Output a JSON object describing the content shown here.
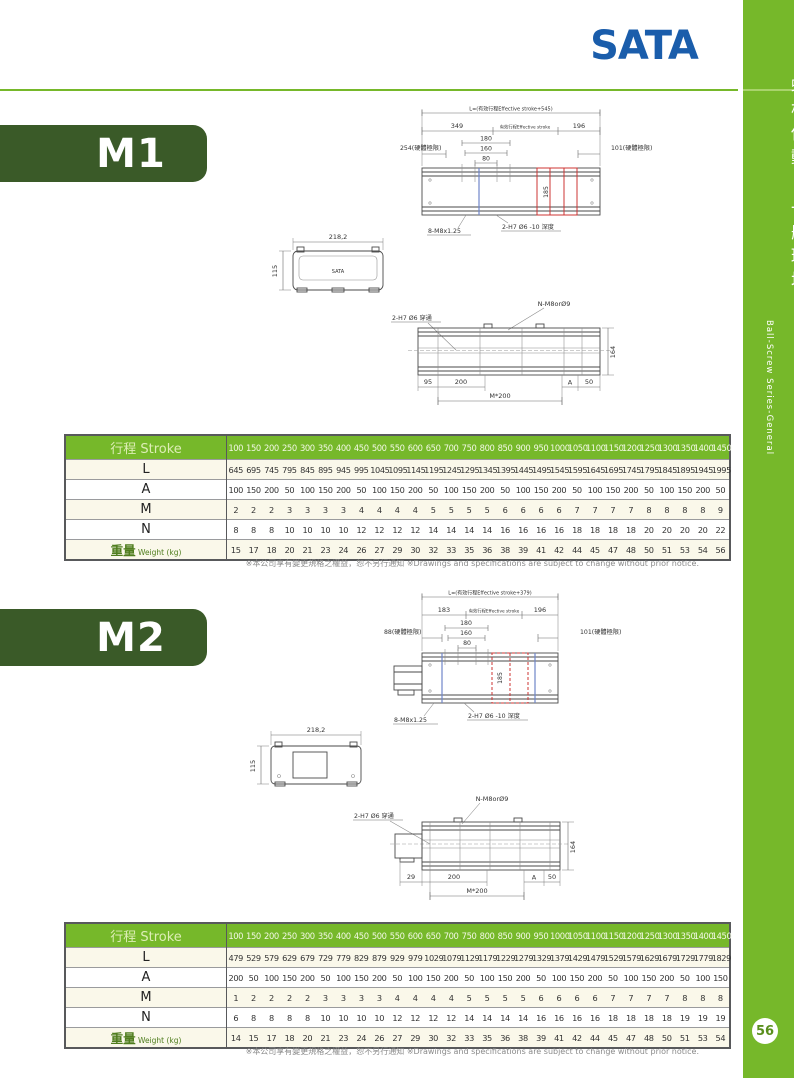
{
  "page": {
    "logo": "SATA",
    "page_number": "56",
    "sidebar_title_cn": "螺桿傳動-一般環境",
    "sidebar_title_en": "Ball-Screw Series-General",
    "disclaimer": "※本公司享有變更規格之權益，恕不另行通知 ※Drawings and specifications are subject to change without prior notice."
  },
  "colors": {
    "green": "#76B82A",
    "dark_green": "#3A5A28",
    "logo_blue": "#1A5DAB",
    "carriage_red": "#cc3433",
    "limit_blue": "#6f86c9"
  },
  "m1": {
    "name": "M1",
    "top_view": {
      "length_formula": "L=(有效行程Effective stroke+545)",
      "dim_left": "349",
      "effective_stroke": "有效行程Effective stroke",
      "dim_right": "196",
      "hard_limit_left": "254(硬體極限)",
      "hard_limit_right": "101(硬體極限)",
      "dim_180": "180",
      "dim_160": "160",
      "dim_80": "80",
      "dim_width": "185",
      "screws": "8-M8x1.25",
      "holes": "2-H7 Ø6 -10 深度"
    },
    "section_view": {
      "dim_w": "218,2",
      "dim_h": "115",
      "logo": "SATA"
    },
    "side_view": {
      "holes_top": "N-M8orØ9",
      "holes_left": "2-H7 Ø6 穿通",
      "dim_1": "95",
      "dim_2": "200",
      "dim_a": "A",
      "dim_3": "50",
      "dim_pitch": "M*200",
      "dim_h": "164"
    },
    "table": {
      "header_label": "行程 Stroke",
      "strokes": [
        100,
        150,
        200,
        250,
        300,
        350,
        400,
        450,
        500,
        550,
        600,
        650,
        700,
        750,
        800,
        850,
        900,
        950,
        1000,
        1050,
        1100,
        1150,
        1200,
        1250,
        1300,
        1350,
        1400,
        1450
      ],
      "rows": [
        {
          "label": "L",
          "values": [
            645,
            695,
            745,
            795,
            845,
            895,
            945,
            995,
            1045,
            1095,
            1145,
            1195,
            1245,
            1295,
            1345,
            1395,
            1445,
            1495,
            1545,
            1595,
            1645,
            1695,
            1745,
            1795,
            1845,
            1895,
            1945,
            1995
          ]
        },
        {
          "label": "A",
          "values": [
            100,
            150,
            200,
            50,
            100,
            150,
            200,
            50,
            100,
            150,
            200,
            50,
            100,
            150,
            200,
            50,
            100,
            150,
            200,
            50,
            100,
            150,
            200,
            50,
            100,
            150,
            200,
            50
          ]
        },
        {
          "label": "M",
          "values": [
            2,
            2,
            2,
            3,
            3,
            3,
            3,
            4,
            4,
            4,
            4,
            5,
            5,
            5,
            5,
            6,
            6,
            6,
            6,
            7,
            7,
            7,
            7,
            8,
            8,
            8,
            8,
            9
          ]
        },
        {
          "label": "N",
          "values": [
            8,
            8,
            8,
            10,
            10,
            10,
            10,
            12,
            12,
            12,
            12,
            14,
            14,
            14,
            14,
            16,
            16,
            16,
            16,
            18,
            18,
            18,
            18,
            20,
            20,
            20,
            20,
            22
          ]
        },
        {
          "label": "重量",
          "label_en": "Weight (kg)",
          "values": [
            15,
            17,
            18,
            20,
            21,
            23,
            24,
            26,
            27,
            29,
            30,
            32,
            33,
            35,
            36,
            38,
            39,
            41,
            42,
            44,
            45,
            47,
            48,
            50,
            51,
            53,
            54,
            56
          ]
        }
      ]
    }
  },
  "m2": {
    "name": "M2",
    "top_view": {
      "length_formula": "L=(有效行程Effective stroke+379)",
      "dim_left": "183",
      "effective_stroke": "有效行程Effective stroke",
      "dim_right": "196",
      "hard_limit_left": "88(硬體極限)",
      "hard_limit_right": "101(硬體極限)",
      "dim_180": "180",
      "dim_160": "160",
      "dim_80": "80",
      "dim_width": "185",
      "screws": "8-M8x1.25",
      "holes": "2-H7 Ø6 -10 深度"
    },
    "section_view": {
      "dim_w": "218,2",
      "dim_h": "115"
    },
    "side_view": {
      "holes_top": "N-M8orØ9",
      "holes_left": "2-H7 Ø6 穿通",
      "dim_1": "29",
      "dim_2": "200",
      "dim_a": "A",
      "dim_3": "50",
      "dim_pitch": "M*200",
      "dim_h": "164"
    },
    "table": {
      "header_label": "行程 Stroke",
      "strokes": [
        100,
        150,
        200,
        250,
        300,
        350,
        400,
        450,
        500,
        550,
        600,
        650,
        700,
        750,
        800,
        850,
        900,
        950,
        1000,
        1050,
        1100,
        1150,
        1200,
        1250,
        1300,
        1350,
        1400,
        1450
      ],
      "rows": [
        {
          "label": "L",
          "values": [
            479,
            529,
            579,
            629,
            679,
            729,
            779,
            829,
            879,
            929,
            979,
            1029,
            1079,
            1129,
            1179,
            1229,
            1279,
            1329,
            1379,
            1429,
            1479,
            1529,
            1579,
            1629,
            1679,
            1729,
            1779,
            1829
          ]
        },
        {
          "label": "A",
          "values": [
            200,
            50,
            100,
            150,
            200,
            50,
            100,
            150,
            200,
            50,
            100,
            150,
            200,
            50,
            100,
            150,
            200,
            50,
            100,
            150,
            200,
            50,
            100,
            150,
            200,
            50,
            100,
            150
          ]
        },
        {
          "label": "M",
          "values": [
            1,
            2,
            2,
            2,
            2,
            3,
            3,
            3,
            3,
            4,
            4,
            4,
            4,
            5,
            5,
            5,
            5,
            6,
            6,
            6,
            6,
            7,
            7,
            7,
            7,
            8,
            8,
            8
          ]
        },
        {
          "label": "N",
          "values": [
            6,
            8,
            8,
            8,
            8,
            10,
            10,
            10,
            10,
            12,
            12,
            12,
            12,
            14,
            14,
            14,
            14,
            16,
            16,
            16,
            16,
            18,
            18,
            18,
            18,
            19,
            19,
            19
          ]
        },
        {
          "label": "重量",
          "label_en": "Weight (kg)",
          "values": [
            14,
            15,
            17,
            18,
            20,
            21,
            23,
            24,
            26,
            27,
            29,
            30,
            32,
            33,
            35,
            36,
            38,
            39,
            41,
            42,
            44,
            45,
            47,
            48,
            50,
            51,
            53,
            54
          ]
        }
      ]
    }
  }
}
